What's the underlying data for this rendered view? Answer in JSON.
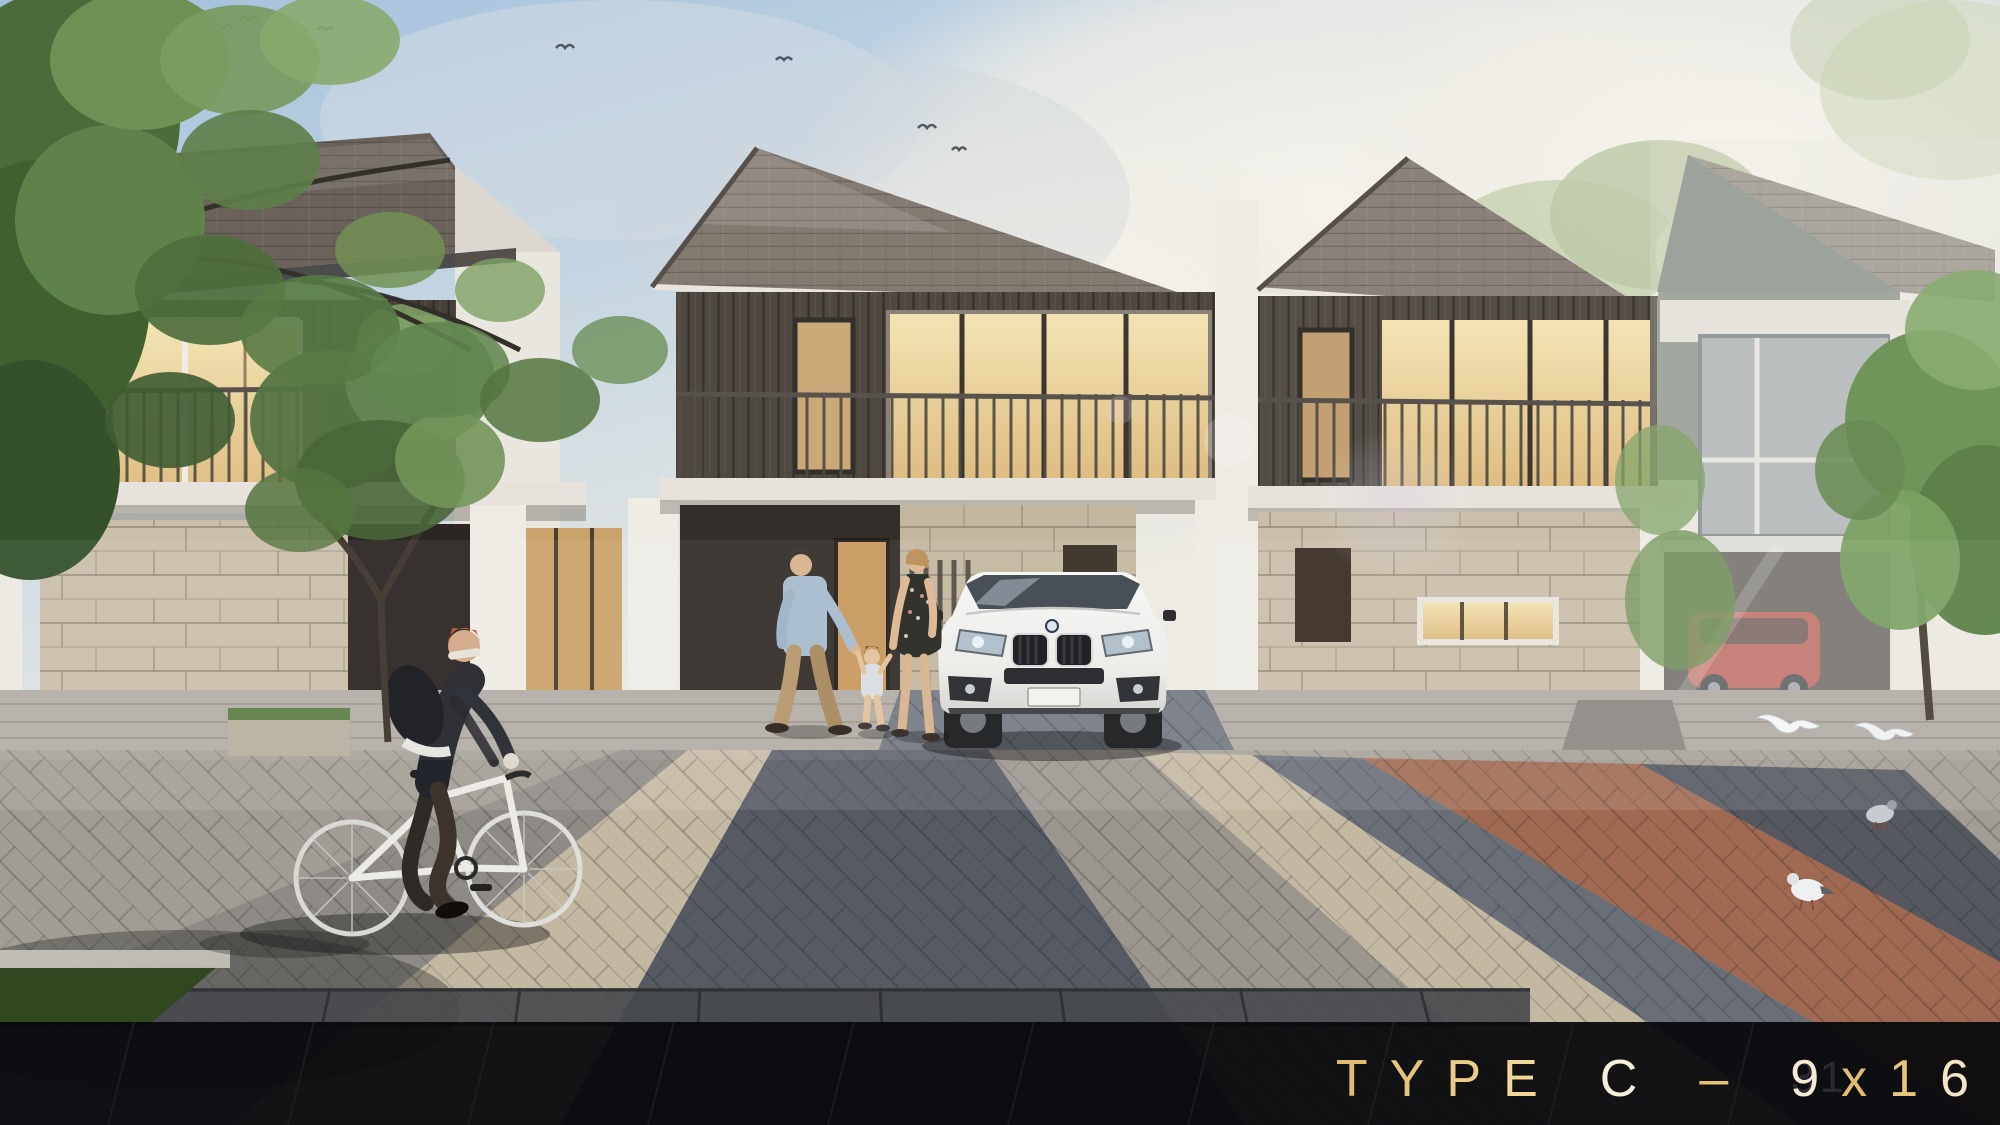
{
  "footer": {
    "title": "TYPE C – 9x16",
    "title_chars": [
      {
        "ch": "T",
        "color": "#e2bb70"
      },
      {
        "ch": "Y",
        "color": "#e7c47b"
      },
      {
        "ch": "P",
        "color": "#eccb86"
      },
      {
        "ch": "E",
        "color": "#f0d697"
      },
      {
        "ch": " ",
        "color": ""
      },
      {
        "ch": "C",
        "color": "#f6efd9"
      },
      {
        "ch": " ",
        "color": ""
      },
      {
        "ch": "–",
        "color": "#e6c173"
      },
      {
        "ch": " ",
        "color": ""
      },
      {
        "ch": "9",
        "color": "#f4ebd2"
      },
      {
        "ch": "x",
        "color": "#e2bd6f"
      },
      {
        "ch": "1",
        "color": "#e8c77c"
      },
      {
        "ch": "6",
        "color": "#f2e6c6"
      }
    ],
    "watermark": "31",
    "bar_color": "#07090c",
    "accent_gold": "#e6c173",
    "accent_cream": "#f5edd6"
  },
  "scene": {
    "house_count": 4,
    "palette": {
      "sky_blue": "#a3c0db",
      "cloud_white": "#f2efe8",
      "roof_shingle": "#837a72",
      "dark_siding": "#4e4840",
      "warm_window": "#f0d9a0",
      "white_wall": "#efece6",
      "stone_clad": "#c9bfaa",
      "grass_green": "#5d7c43",
      "plaza_gray": "#a19c94",
      "plaza_beige": "#c3b8a2",
      "plaza_dark": "#565a63",
      "plaza_terracotta": "#a06a52",
      "suv_white": "#f2f2f0",
      "red_car": "#b5352a"
    }
  }
}
